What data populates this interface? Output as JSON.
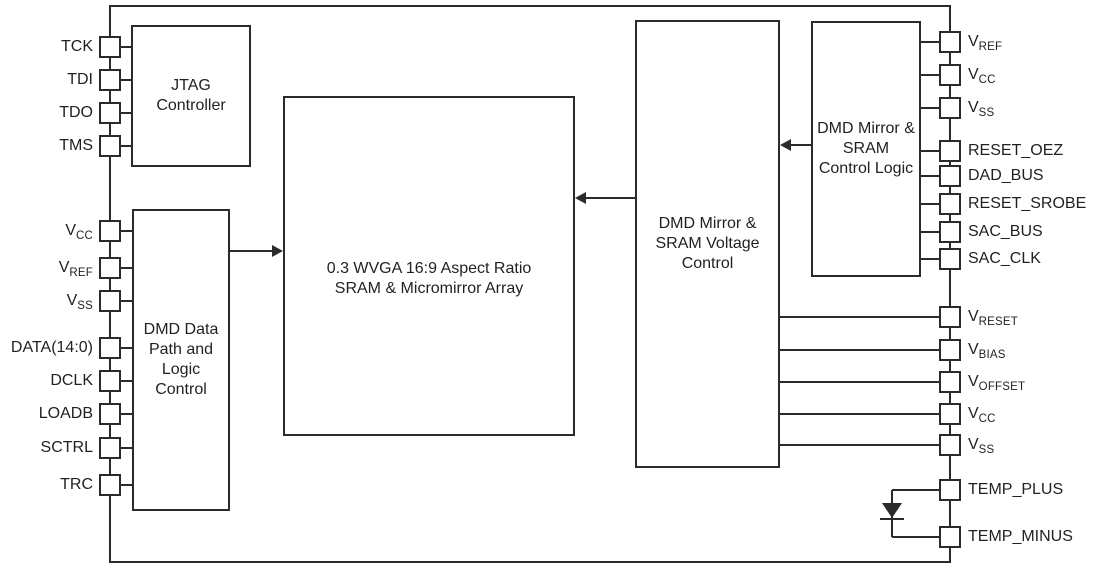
{
  "blocks": {
    "jtag": {
      "label": "JTAG\nController"
    },
    "data_path": {
      "label": "DMD Data\nPath and\nLogic\nControl"
    },
    "array": {
      "label": "0.3 WVGA 16:9 Aspect Ratio\nSRAM & Micromirror Array"
    },
    "voltage_control": {
      "label": "DMD Mirror &\nSRAM Voltage\nControl"
    },
    "control_logic": {
      "label": "DMD Mirror &\nSRAM\nControl Logic"
    }
  },
  "pins": {
    "left": [
      {
        "base": "TCK",
        "sub": ""
      },
      {
        "base": "TDI",
        "sub": ""
      },
      {
        "base": "TDO",
        "sub": ""
      },
      {
        "base": "TMS",
        "sub": ""
      },
      {
        "base": "V",
        "sub": "CC"
      },
      {
        "base": "V",
        "sub": "REF"
      },
      {
        "base": "V",
        "sub": "SS"
      },
      {
        "base": "DATA(14:0)",
        "sub": ""
      },
      {
        "base": "DCLK",
        "sub": ""
      },
      {
        "base": "LOADB",
        "sub": ""
      },
      {
        "base": "SCTRL",
        "sub": ""
      },
      {
        "base": "TRC",
        "sub": ""
      }
    ],
    "right": [
      {
        "base": "V",
        "sub": "REF"
      },
      {
        "base": "V",
        "sub": "CC"
      },
      {
        "base": "V",
        "sub": "SS"
      },
      {
        "base": "RESET_OEZ",
        "sub": ""
      },
      {
        "base": "DAD_BUS",
        "sub": ""
      },
      {
        "base": "RESET_SROBE",
        "sub": ""
      },
      {
        "base": "SAC_BUS",
        "sub": ""
      },
      {
        "base": "SAC_CLK",
        "sub": ""
      },
      {
        "base": "V",
        "sub": "RESET"
      },
      {
        "base": "V",
        "sub": "BIAS"
      },
      {
        "base": "V",
        "sub": "OFFSET"
      },
      {
        "base": "V",
        "sub": "CC"
      },
      {
        "base": "V",
        "sub": "SS"
      },
      {
        "base": "TEMP_PLUS",
        "sub": ""
      },
      {
        "base": "TEMP_MINUS",
        "sub": ""
      }
    ]
  },
  "colors": {
    "line": "#2b2b2b",
    "text": "#231f20",
    "background": "#ffffff"
  }
}
